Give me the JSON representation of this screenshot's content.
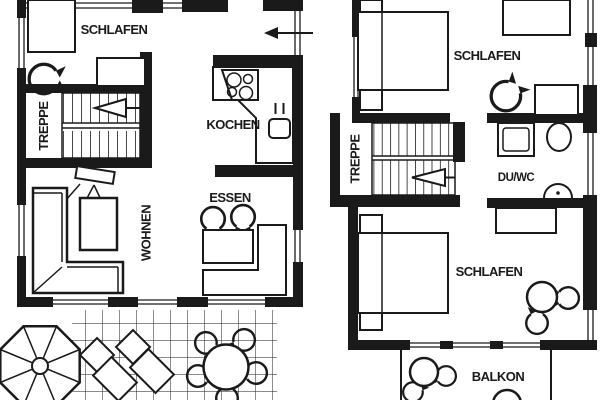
{
  "drawing": {
    "type": "floor-plan",
    "colors": {
      "ink": "#1a1a1a",
      "paper": "#ffffff"
    },
    "ground_floor": {
      "schlafen": "SCHLAFEN",
      "treppe": "TREPPE",
      "kochen": "KOCHEN",
      "essen": "ESSEN",
      "wohnen": "WOHNEN"
    },
    "upper_floor": {
      "schlafen_top": "SCHLAFEN",
      "treppe": "TREPPE",
      "du_wc": "DU/WC",
      "schlafen_bottom": "SCHLAFEN",
      "balkon": "BALKON"
    }
  }
}
